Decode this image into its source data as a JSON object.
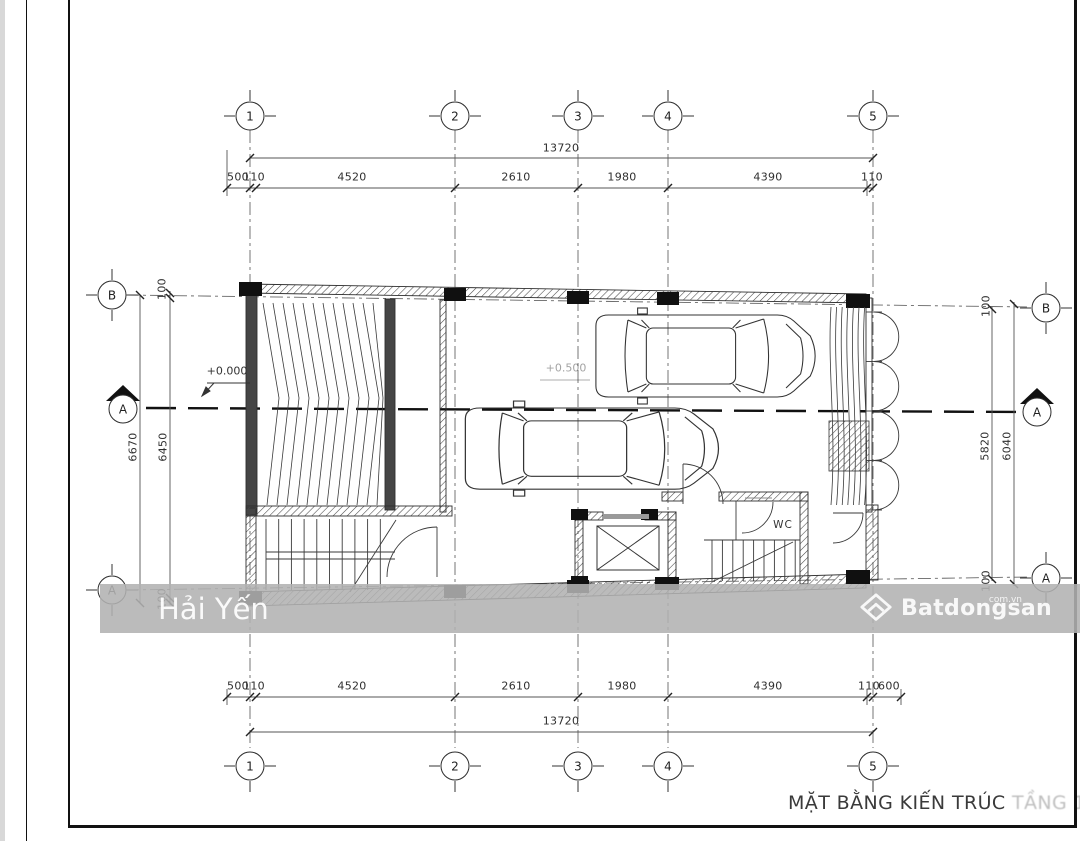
{
  "sheet": {
    "title_main": "MẶT BẰNG KIẾN TRÚC",
    "title_faded": " TẦNG 1"
  },
  "watermark": {
    "name": "Hải Yến",
    "brand": "Batdongsan",
    "brand_sup": "com.vn"
  },
  "labels": {
    "wc": "WC",
    "level_zero": "+0.000",
    "level_mid": "+0.500"
  },
  "grid": {
    "cols": [
      "1",
      "2",
      "3",
      "4",
      "5"
    ],
    "rows": [
      "B",
      "A"
    ],
    "section": "A"
  },
  "dims": {
    "top": {
      "total": "13720",
      "segments": [
        "500",
        "110",
        "4520",
        "2610",
        "1980",
        "4390",
        "110"
      ]
    },
    "bottom": {
      "total": "13720",
      "segments": [
        "500",
        "110",
        "4520",
        "2610",
        "1980",
        "4390",
        "110",
        "600"
      ]
    },
    "left": {
      "outer": "6670",
      "inner": "6450",
      "cap_top": "100",
      "cap_bottom": "100"
    },
    "right": {
      "inner": "5820",
      "outer": "6040",
      "cap_top": "100",
      "cap_bottom": "100"
    }
  }
}
